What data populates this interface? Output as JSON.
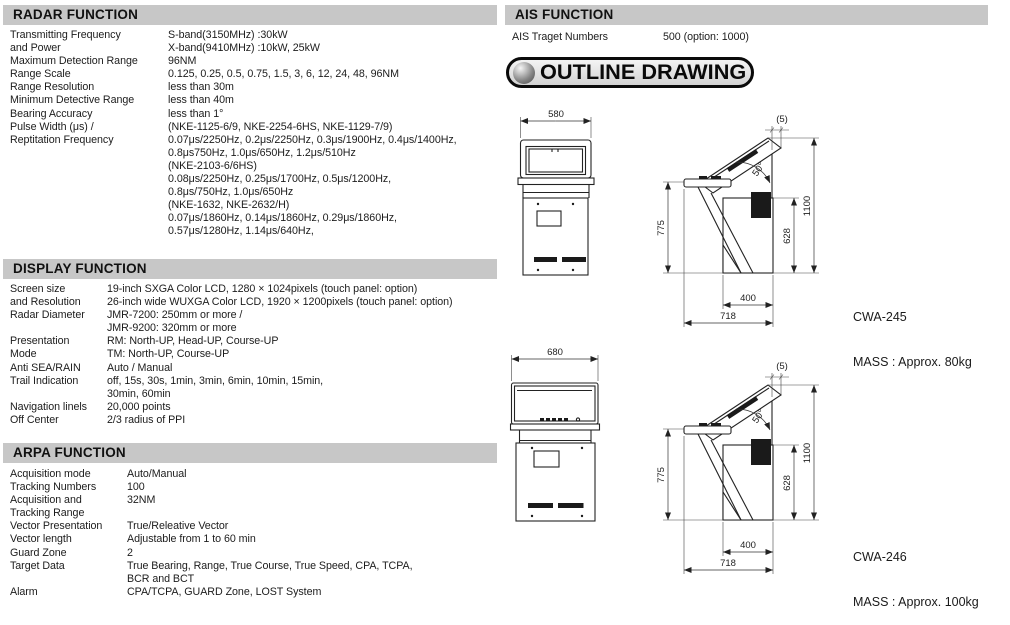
{
  "meta": {
    "bar_color": "#c7c7c7",
    "background": "#ffffff",
    "line_color": "#222222"
  },
  "sections": {
    "radar": {
      "header": "RADAR FUNCTION",
      "rows": [
        {
          "label": "Transmitting Frequency\nand Power",
          "value": "S-band(3150MHz) :30kW\nX-band(9410MHz) :10kW, 25kW"
        },
        {
          "label": "Maximum Detection Range",
          "value": "96NM"
        },
        {
          "label": "Range Scale",
          "value": "0.125, 0.25, 0.5, 0.75, 1.5, 3, 6, 12, 24, 48, 96NM"
        },
        {
          "label": "Range Resolution",
          "value": "less than 30m"
        },
        {
          "label": "Minimum Detective Range",
          "value": "less than 40m"
        },
        {
          "label": "Bearing Accuracy",
          "value": "less than 1°"
        },
        {
          "label": "Pulse Width (μs) /\nReptitation Frequency",
          "value": "(NKE-1125-6/9, NKE-2254-6HS, NKE-1129-7/9)\n0.07μs/2250Hz, 0.2μs/2250Hz, 0.3μs/1900Hz, 0.4μs/1400Hz,\n0.8μs750Hz, 1.0μs/650Hz, 1.2μs/510Hz\n(NKE-2103-6/6HS)\n0.08μs/2250Hz, 0.25μs/1700Hz, 0.5μs/1200Hz,\n0.8μs/750Hz, 1.0μs/650Hz\n(NKE-1632, NKE-2632/H)\n0.07μs/1860Hz, 0.14μs/1860Hz, 0.29μs/1860Hz,\n0.57μs/1280Hz, 1.14μs/640Hz,"
        }
      ]
    },
    "display": {
      "header": "DISPLAY FUNCTION",
      "rows": [
        {
          "label": "Screen size\nand Resolution",
          "value": "19-inch SXGA Color LCD, 1280 × 1024pixels (touch panel: option)\n26-inch wide WUXGA Color LCD, 1920 × 1200pixels (touch panel: option)"
        },
        {
          "label": "Radar Diameter",
          "value": "JMR-7200: 250mm or more /\nJMR-9200: 320mm or more"
        },
        {
          "label": "Presentation\nMode",
          "value": "RM: North-UP, Head-UP, Course-UP\nTM: North-UP, Course-UP"
        },
        {
          "label": "Anti SEA/RAIN",
          "value": "Auto / Manual"
        },
        {
          "label": "Trail Indication",
          "value": "off, 15s, 30s, 1min, 3min, 6min, 10min, 15min,\n30min, 60min"
        },
        {
          "label": "Navigation linels",
          "value": "20,000 points"
        },
        {
          "label": "Off Center",
          "value": "2/3 radius of PPI"
        }
      ]
    },
    "arpa": {
      "header": "ARPA FUNCTION",
      "rows": [
        {
          "label": "Acquisition mode",
          "value": "Auto/Manual"
        },
        {
          "label": "Tracking Numbers",
          "value": "100"
        },
        {
          "label": "Acquisition and\nTracking Range",
          "value": "32NM"
        },
        {
          "label": "Vector Presentation",
          "value": "True/Releative Vector"
        },
        {
          "label": "Vector length",
          "value": "Adjustable from 1 to 60 min"
        },
        {
          "label": "Guard Zone",
          "value": "2"
        },
        {
          "label": "Target Data",
          "value": "True Bearing, Range, True Course, True Speed, CPA, TCPA,\nBCR and BCT"
        },
        {
          "label": "Alarm",
          "value": "CPA/TCPA, GUARD Zone, LOST System"
        }
      ]
    },
    "ais": {
      "header": "AIS FUNCTION",
      "rows": [
        {
          "label": "AIS Traget Numbers",
          "value": "500 (option: 1000)"
        }
      ]
    }
  },
  "outline": {
    "title": "OUTLINE DRAWING",
    "drawings": [
      {
        "model": "CWA-245",
        "mass": "MASS : Approx. 80kg",
        "dims": {
          "front_width": "580",
          "console_height": "775",
          "overall_height": "1100",
          "rear_height": "628",
          "base_depth": "400",
          "overall_depth": "718",
          "top_offset": "(5)",
          "tilt_angle": "50°"
        }
      },
      {
        "model": "CWA-246",
        "mass": "MASS : Approx. 100kg",
        "dims": {
          "front_width": "680",
          "console_height": "775",
          "overall_height": "1100",
          "rear_height": "628",
          "base_depth": "400",
          "overall_depth": "718",
          "top_offset": "(5)",
          "tilt_angle": "50°"
        }
      }
    ]
  }
}
